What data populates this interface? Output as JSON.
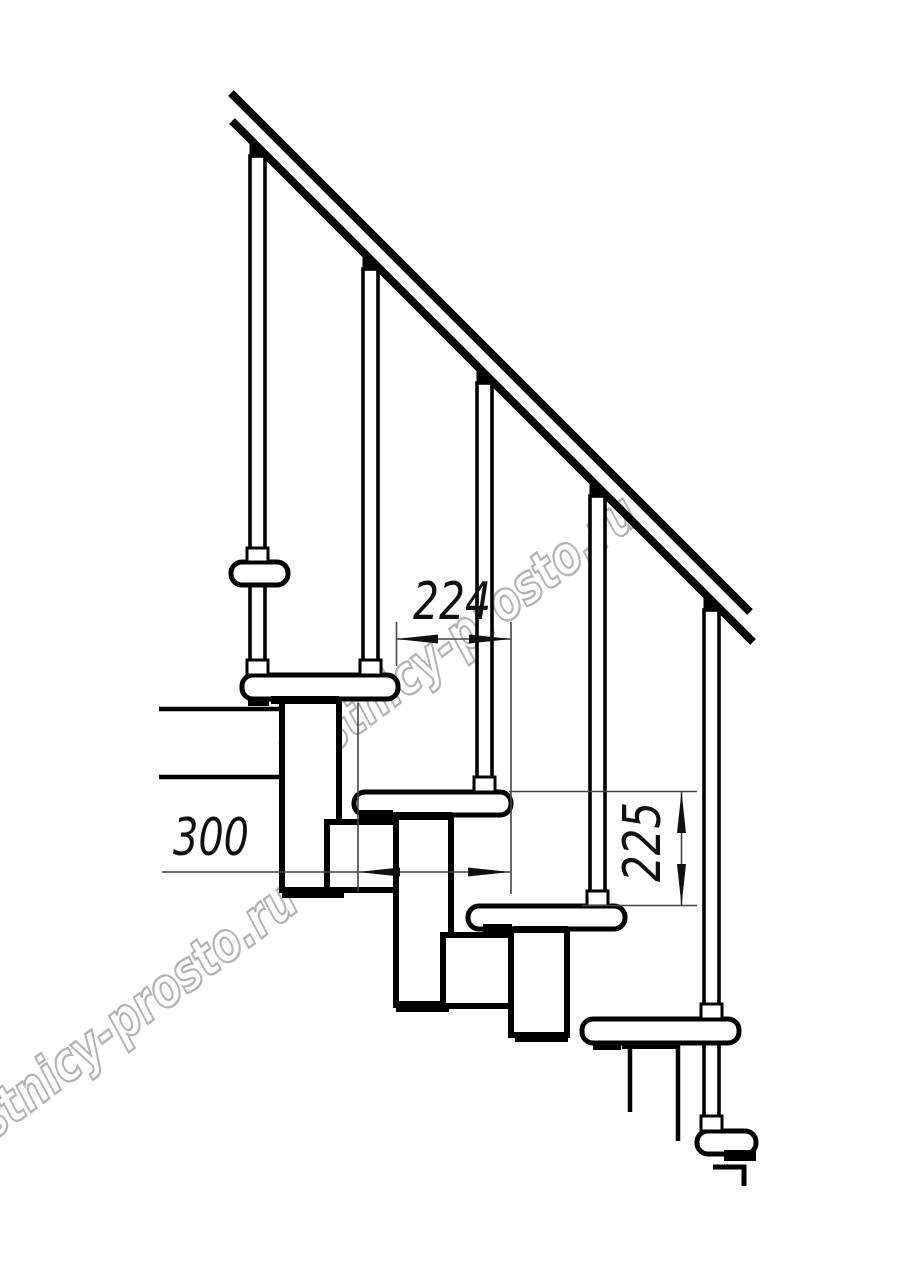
{
  "page": {
    "background": "#ffffff"
  },
  "drawing": {
    "dimensions": {
      "step_run": "224",
      "tread_depth": "300",
      "step_rise": "225"
    },
    "watermark": {
      "text": "lestnicy-prosto.ru"
    },
    "colors": {
      "line": "#000000",
      "fill": "#ffffff",
      "dim_line": "#444444",
      "dim_text": "#111111",
      "watermark": "#b3b3b3"
    }
  }
}
